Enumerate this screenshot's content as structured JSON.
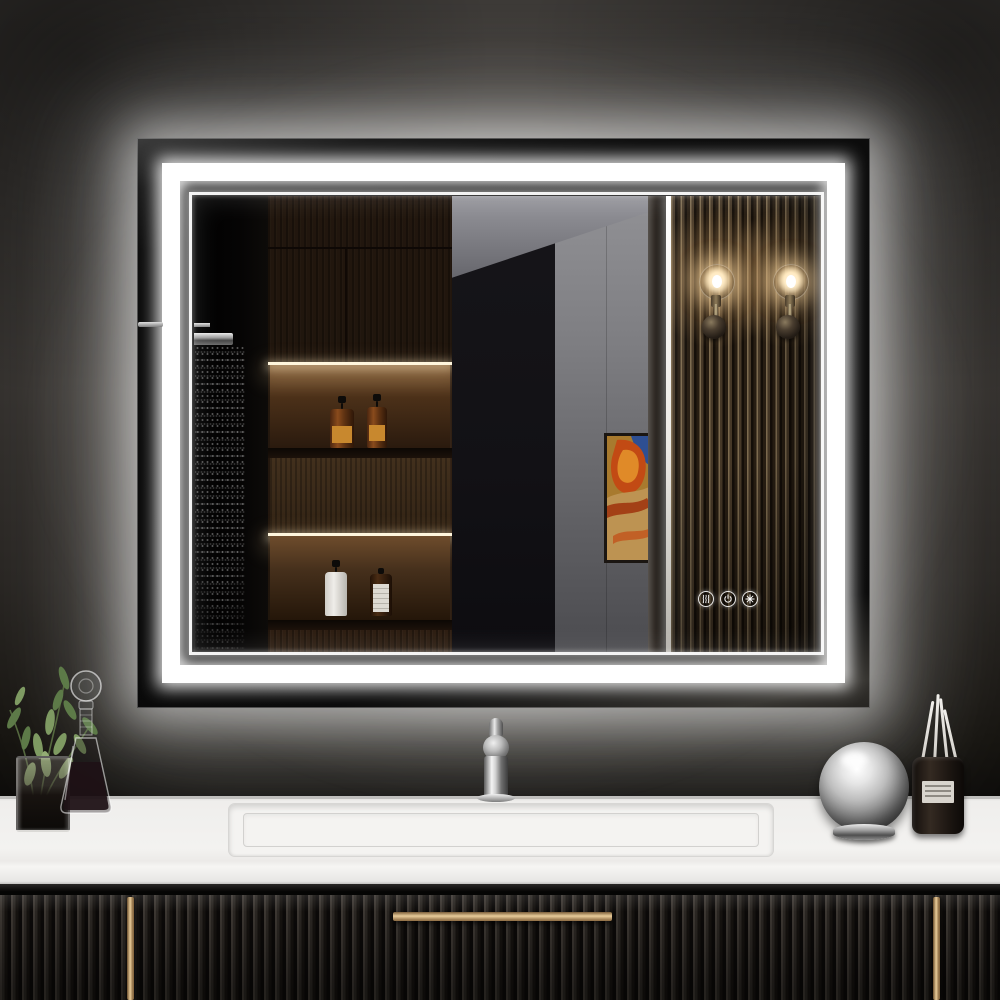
{
  "subject": "LED backlit rectangular bathroom vanity mirror over a dark fluted vanity cabinet",
  "environment": {
    "wall_color": "#2e2b28",
    "halo_color": "#ffffff",
    "countertop_color": "#f0efed",
    "cabinet_color": "#1d1a17",
    "handle_color": "#d9b788"
  },
  "mirror": {
    "led_frame_color": "#ffffff",
    "touch_controls": [
      {
        "icon": "defogger-icon",
        "label": "anti-fog"
      },
      {
        "icon": "power-icon",
        "label": "power"
      },
      {
        "icon": "color-temperature-icon",
        "label": "color temperature"
      }
    ]
  },
  "reflection": {
    "items": [
      {
        "name": "rain-shower-with-spray",
        "label": "rain shower head with running water"
      },
      {
        "name": "dark-wood-shelving",
        "label": "dark wood cabinet and open shelves"
      },
      {
        "name": "amber-pump-bottles",
        "label": "two amber pump bottles with orange labels"
      },
      {
        "name": "white-pump-bottle",
        "label": "white pump bottle"
      },
      {
        "name": "amber-bottle-white-label",
        "label": "amber bottle with white label"
      },
      {
        "name": "gray-wall-and-ceiling",
        "label": "gray wall and ceiling"
      },
      {
        "name": "abstract-framed-artwork",
        "label": "abstract framed artwork"
      },
      {
        "name": "backlit-panel-edge",
        "label": "lit panel edge"
      },
      {
        "name": "slatted-wood-panel",
        "label": "vertical slatted wood panel"
      },
      {
        "name": "glass-globe-sconces",
        "label": "two lit glass globe wall sconces"
      }
    ]
  },
  "countertop_items": [
    {
      "name": "greenery-in-glass-vase",
      "label": "greenery in glass vase"
    },
    {
      "name": "glass-decanter",
      "label": "glass decanter with ball stopper"
    },
    {
      "name": "chrome-faucet",
      "label": "chrome single-handle faucet"
    },
    {
      "name": "rectangular-sink",
      "label": "integrated rectangular sink"
    },
    {
      "name": "chrome-sphere-ornament",
      "label": "chrome sphere ornament on stand"
    },
    {
      "name": "reed-diffuser",
      "label": "reed diffuser with four reeds",
      "reeds": 4
    }
  ],
  "vanity": {
    "style": "fluted",
    "handles": [
      {
        "name": "left-vertical-handle",
        "label": "left door handle"
      },
      {
        "name": "center-horizontal-handle",
        "label": "center drawer handle"
      },
      {
        "name": "right-vertical-handle",
        "label": "right door handle"
      }
    ]
  }
}
